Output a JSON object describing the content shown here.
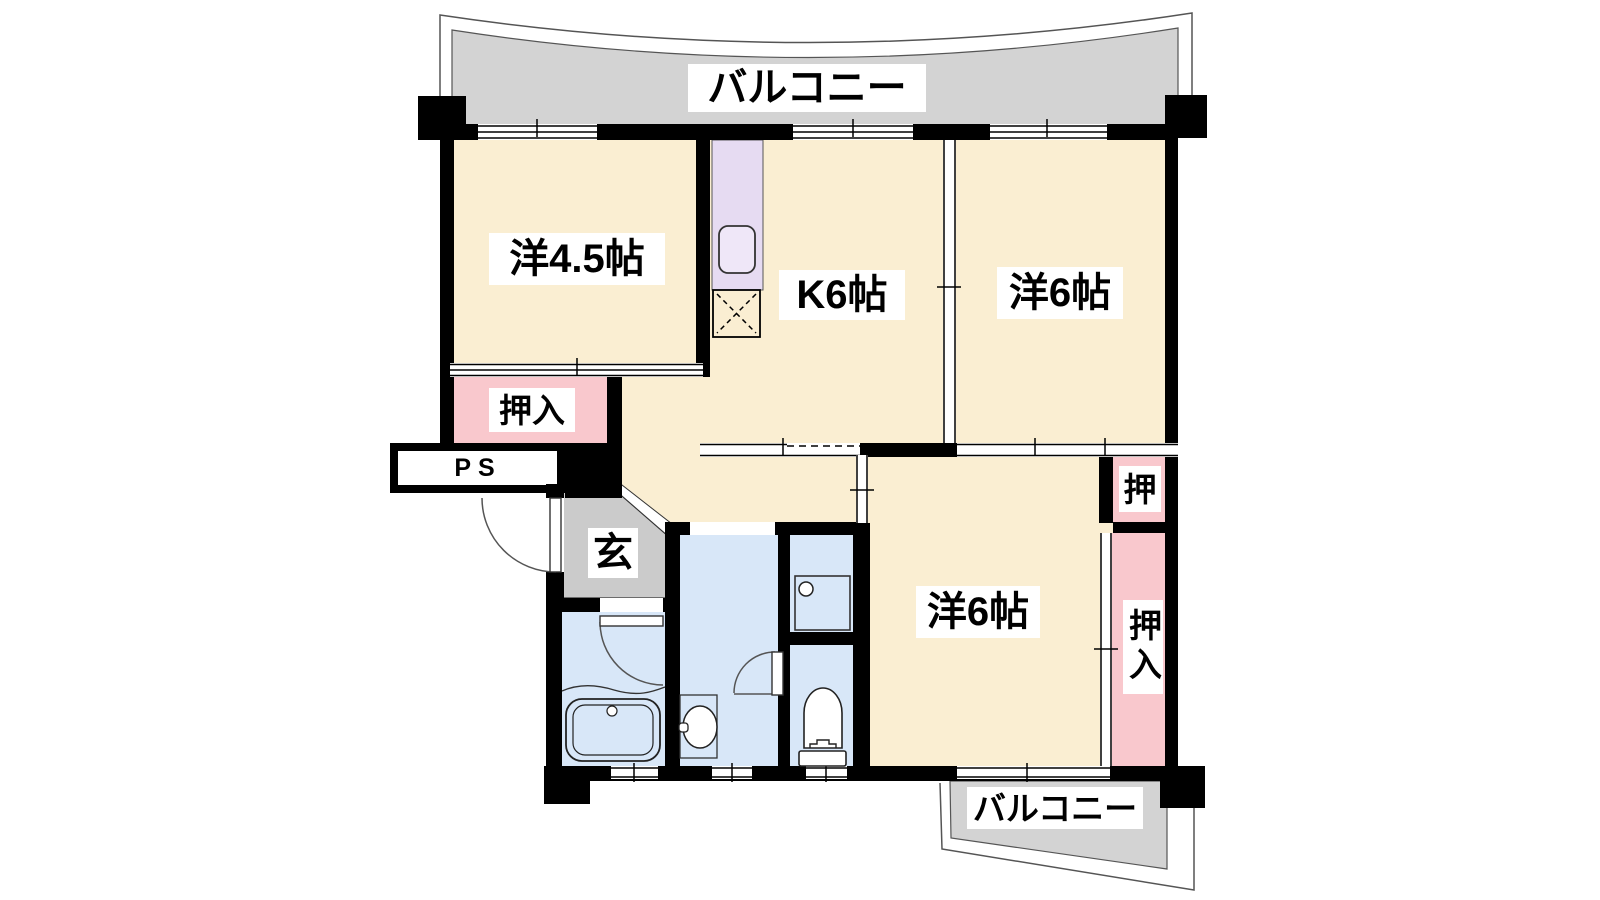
{
  "floorplan": {
    "balcony_top_label": "バルコニー",
    "balcony_bottom_label": "バルコニー",
    "rooms": {
      "west": "洋4.5帖",
      "kitchen": "K6帖",
      "northeast": "洋6帖",
      "southeast": "洋6帖"
    },
    "entrance_label": "玄",
    "closets": {
      "west": "押入",
      "small": "押",
      "east": "押入"
    },
    "pipe_space_label": "PS",
    "colors": {
      "room_floor": "#FAEED2",
      "closet": "#F9C8CD",
      "kitchen_counter": "#E6DBF2",
      "wet_area": "#D8E7F8",
      "balcony": "#D3D3D3",
      "entrance_floor": "#CBCBCB",
      "wall": "#000000",
      "fixture_fill": "#FFFFFF"
    }
  }
}
